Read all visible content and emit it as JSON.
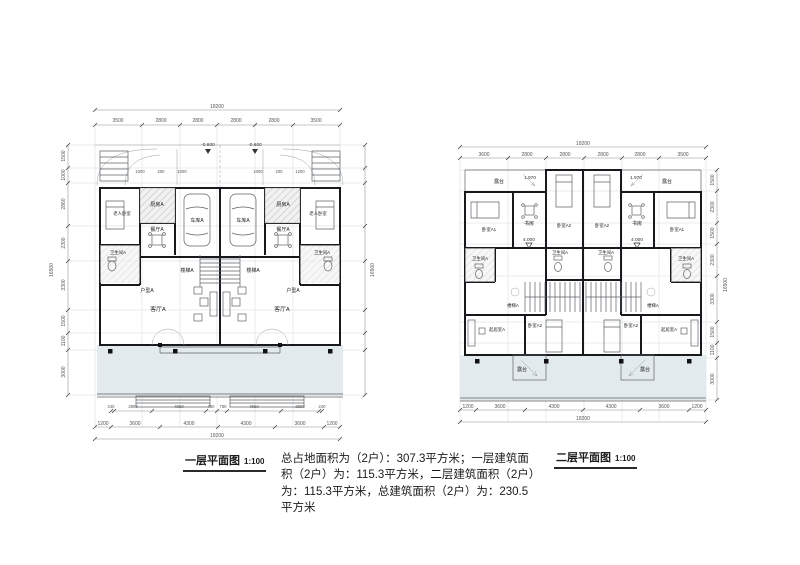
{
  "captions": {
    "plan1_title": "一层平面图",
    "plan1_scale": "1:100",
    "plan2_title": "二层平面图",
    "plan2_scale": "1:100"
  },
  "summary_text": "总占地面积为（2户）：307.3平方米；一层建筑面积（2户）为：115.3平方米，二层建筑面积（2户）为：115.3平方米，总建筑面积（2户）为：230.5平方米",
  "plan1": {
    "total_width": "18200",
    "top_dims": [
      "3500",
      "2800",
      "2800",
      "2800",
      "2800",
      "3500"
    ],
    "drive_dims": [
      "1000",
      "200",
      "1000",
      "1000",
      "200",
      "1200"
    ],
    "level_mark": "-0.600",
    "side_dims": [
      "1500",
      "1000",
      "2860",
      "2300",
      "3300",
      "1500",
      "1100",
      "3000"
    ],
    "side_total": "16500",
    "bottom_inner_dims": [
      "240",
      "2800",
      "4050",
      "750",
      "750",
      "4050",
      "2800",
      "240"
    ],
    "bottom_outer_dims": [
      "1200",
      "3600",
      "4300",
      "4300",
      "3600",
      "1200"
    ],
    "total_bottom": "18200",
    "rooms": {
      "kitchen": "厨房A",
      "garage": "车库A",
      "elder_bedroom": "老人卧室",
      "dining": "餐厅A",
      "bathroom": "卫生间A",
      "stairs": "楼梯A",
      "unit": "户型A",
      "living": "客厅A"
    }
  },
  "plan2": {
    "total_width": "18200",
    "top_dims": [
      "3600",
      "2800",
      "2800",
      "2800",
      "2800",
      "3500"
    ],
    "slope_mark": "1.970",
    "level_mark": "4.000",
    "side_dims": [
      "1500",
      "2300",
      "1500",
      "2300",
      "3300",
      "1500",
      "1100",
      "3000"
    ],
    "side_total": "16500",
    "bottom_dims": [
      "1200",
      "3600",
      "4300",
      "4300",
      "3600",
      "1200"
    ],
    "total_bottom": "18200",
    "rooms": {
      "terrace": "露台",
      "bedroom1": "卧室A1",
      "study": "书房",
      "bedroom2": "卧室A2",
      "bathroom": "卫生间A",
      "stairs": "楼梯A",
      "living": "起居室A"
    }
  }
}
